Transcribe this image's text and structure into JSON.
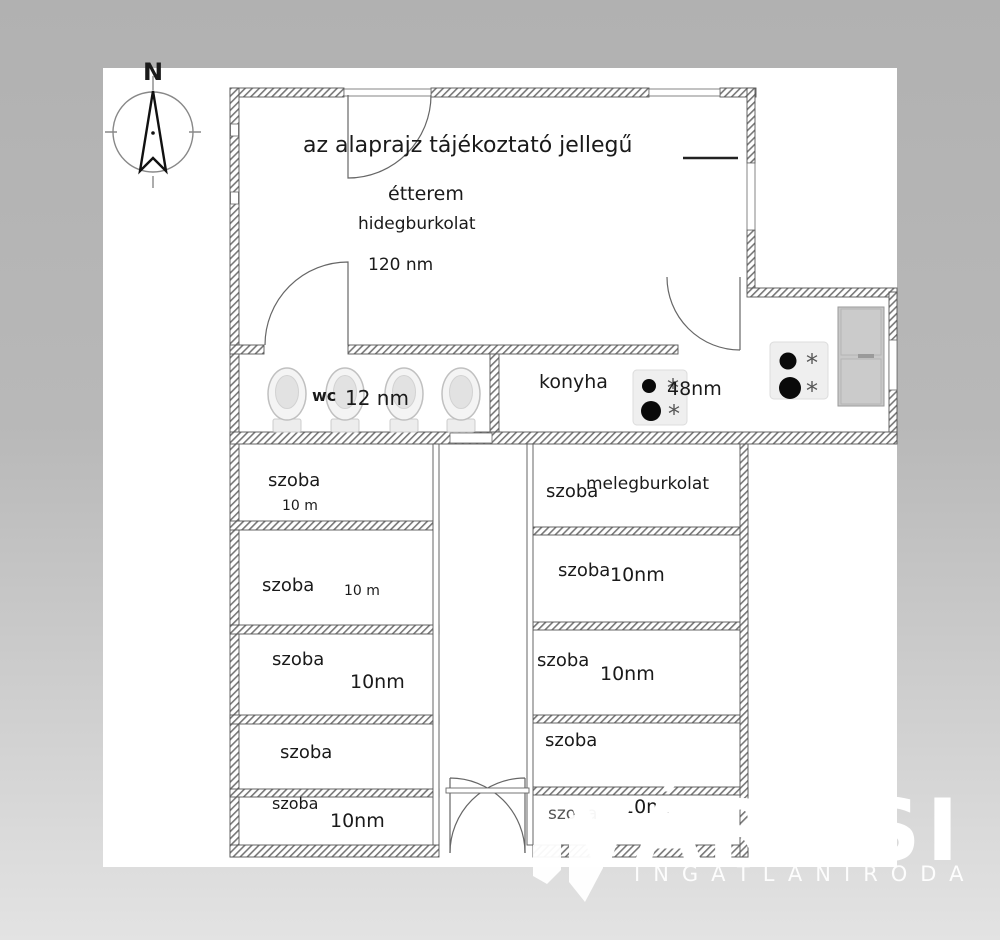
{
  "floorplan": {
    "disclaimer": "az alaprajz tájékoztató jellegű",
    "compass_label": "N",
    "restaurant": {
      "name": "étterem",
      "flooring": "hidegburkolat",
      "area": "120 nm"
    },
    "wc": {
      "name": "wc",
      "area": "12 nm"
    },
    "kitchen": {
      "name": "konyha",
      "area": "48nm"
    },
    "left_rooms": [
      {
        "name": "szoba",
        "area": "10 m"
      },
      {
        "name": "szoba",
        "area": "10 m"
      },
      {
        "name": "szoba",
        "area": "10nm"
      },
      {
        "name": "szoba",
        "area": ""
      },
      {
        "name": "szoba",
        "area": "10nm"
      }
    ],
    "right_rooms": [
      {
        "name": "szoba",
        "flooring": "melegburkolat",
        "area": ""
      },
      {
        "name": "szoba",
        "area": "10nm"
      },
      {
        "name": "szoba",
        "area": "10nm"
      },
      {
        "name": "szoba",
        "area": ""
      },
      {
        "name": "szoba",
        "area": "10nm"
      }
    ]
  },
  "watermark": {
    "brand": "VÁROSI",
    "subtitle": "INGATLANIRODA"
  },
  "colors": {
    "background_top": "#b1b1b1",
    "background_bottom": "#e3e3e3",
    "canvas": "#ffffff",
    "wall_line": "#555555",
    "watermark": "#ffffff"
  }
}
